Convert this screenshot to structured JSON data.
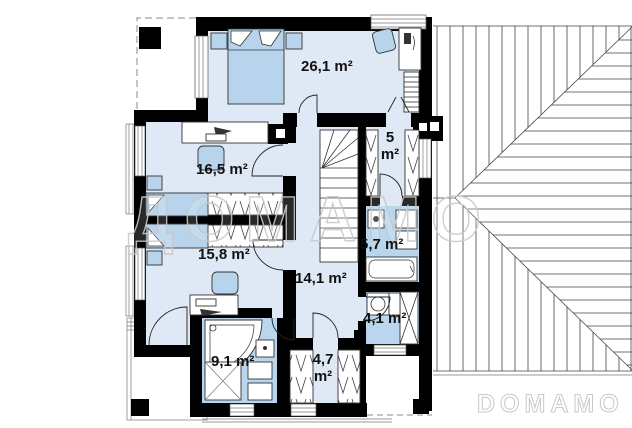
{
  "branding": {
    "watermark": "ДОМАМО",
    "logo": "DOMAMO"
  },
  "rooms": {
    "bedroom_26": {
      "label": "26,1 m²"
    },
    "bedroom_16": {
      "label": "16,5 m²"
    },
    "bedroom_15": {
      "label": "15,8 m²"
    },
    "hall_14": {
      "label": "14,1 m²"
    },
    "wardrobe_5": {
      "line1": "5",
      "line2": "m²"
    },
    "bathroom_57": {
      "label": "5,7 m²"
    },
    "laundry_41": {
      "label": "4,1 m²"
    },
    "closet_47": {
      "line1": "4,7",
      "line2": "m²"
    },
    "bathroom_91": {
      "label": "9,1 m²"
    }
  },
  "colors": {
    "wall": "#000000",
    "floor": "#dfe9f6",
    "wet_floor": "#b9d6ee",
    "furniture": "#b7d4ec",
    "outline": "#333333",
    "roof_line": "#444444",
    "watermark_color": "#c9c9c9",
    "label_color": "#111111"
  }
}
